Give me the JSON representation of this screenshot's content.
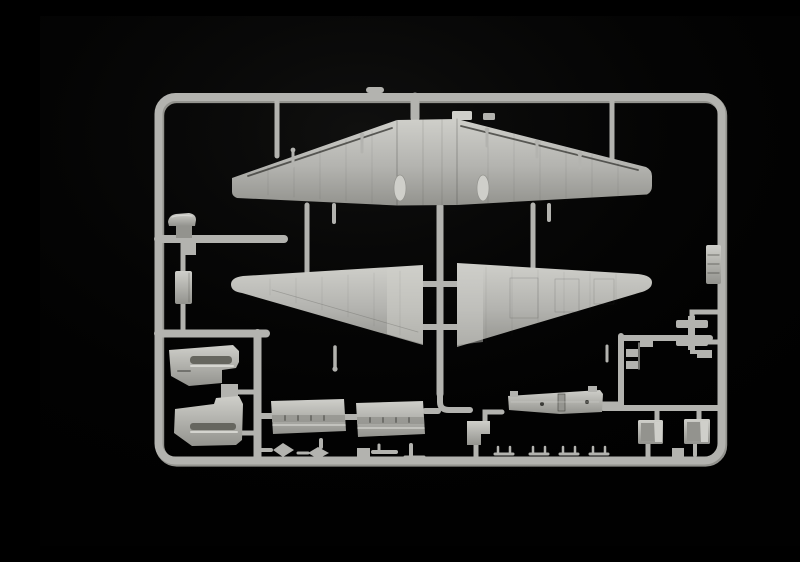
{
  "scene": {
    "type": "photograph",
    "description": "Light grey injection-moulded plastic model kit sprue with twin-engine aircraft parts, photographed on a black background",
    "background": "black studio backdrop"
  },
  "colors": {
    "bg": "#010101",
    "plastic": "#b3b3af",
    "plasticLight": "#cfcfca",
    "plasticDark": "#93938e",
    "plasticDeep": "#66665f",
    "lineDark": "#3c3c38",
    "highlight": "#e0e0db"
  },
  "parts": {
    "frame": "rectangular sprue runner frame",
    "upper_wing": "one-piece upper wing moulding with engine openings",
    "lower_wing_left": "left lower wing half",
    "lower_wing_right": "right lower wing half",
    "nacelle_upper": "engine cowling side with exhaust slots (upper)",
    "nacelle_lower": "engine cowling side with exhaust slots (lower)",
    "scoop": "small intake scoop part",
    "stub_rect": "small rectangular fairing part",
    "door_1": "engine nacelle door panel 1",
    "door_2": "engine nacelle door panel 2",
    "floor": "flat bomb-bay / floor panel with slot and locating holes",
    "bracket": "stepped bracket part",
    "radiator_1": "boxed radiator part 1",
    "radiator_2": "boxed radiator part 2",
    "cluster_right": "cluster of small struts and rungs",
    "edge_clip": "ribbed clip part on right frame rail",
    "small_row": "row of small clips and fittings on bottom rail"
  }
}
